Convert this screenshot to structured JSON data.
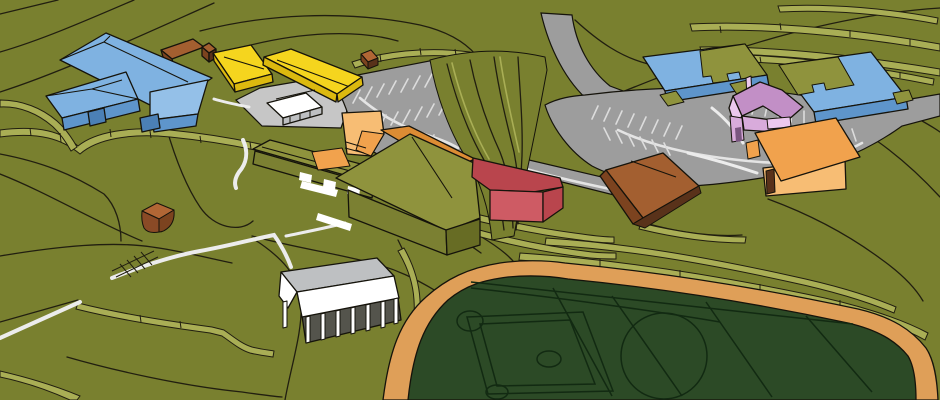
{
  "scene": {
    "description": "SketchUp-style 3D aerial massing model of a school campus: terraced olive hillside with contour lines, color-coded buildings, gray parking lots with striped stalls, curving access road, white walkways, an open-air pavilion, and a dark green athletic field with baseball diamond ringed by an orange track",
    "objects": [
      {
        "name": "elementary-school",
        "color_key": "blue_roof"
      },
      {
        "name": "classroom-wing-yellow",
        "color_key": "yellow_roof"
      },
      {
        "name": "gymnasium",
        "color_key": "olive_roof"
      },
      {
        "name": "amphitheater",
        "color_key": "orange_light"
      },
      {
        "name": "cafeteria-red",
        "color_key": "red_roof"
      },
      {
        "name": "barn-brown",
        "color_key": "brown_roof"
      },
      {
        "name": "middle-school-east",
        "color_key": "blue_roof"
      },
      {
        "name": "house-pink",
        "color_key": "pink_roof"
      },
      {
        "name": "hall-orange",
        "color_key": "orange"
      },
      {
        "name": "pavilion-white",
        "color_key": "white"
      },
      {
        "name": "quonset-shed",
        "color_key": "quonset_top"
      },
      {
        "name": "athletic-field",
        "color_key": "field"
      },
      {
        "name": "running-track",
        "color_key": "track"
      }
    ],
    "colors": {
      "terrain": "#79802f",
      "terrace_face": "#a9ae55",
      "contour": "#211e10",
      "outline": "#15130b",
      "road": "#9d9d9d",
      "plaza": "#c6c6c6",
      "curb": "#e4e4e4",
      "stripe": "#dcdcdc",
      "walk": "#ececec",
      "field": "#2c4a26",
      "field_line": "#122a12",
      "track": "#df9f58",
      "blue_roof": "#7fb2e1",
      "blue_roof_light": "#94c0e8",
      "blue_wall": "#5e95cb",
      "blue_wall_dark": "#4b80b6",
      "yellow_roof": "#f5d51e",
      "yellow_wall": "#dcb90f",
      "orange": "#f1a24d",
      "orange_light": "#f7bd74",
      "orange_dark": "#dc8c34",
      "red_roof": "#b9454d",
      "red_wall": "#ce5b64",
      "brown_roof": "#a35f30",
      "brown_wall": "#7c431f",
      "brown_dark": "#59321a",
      "olive_roof": "#8f933d",
      "olive_wall": "#7b8032",
      "olive_wall_dark": "#676c24",
      "pink_roof": "#c28fc6",
      "pink_light": "#ecc8ee",
      "pink_wall": "#d8abdb",
      "pink_dark": "#7a5680",
      "white": "#ffffff",
      "gray_roof": "#bec0c2",
      "interior_dark": "#54544c",
      "quonset_top": "#b16635",
      "quonset_front": "#8a4a26"
    }
  }
}
